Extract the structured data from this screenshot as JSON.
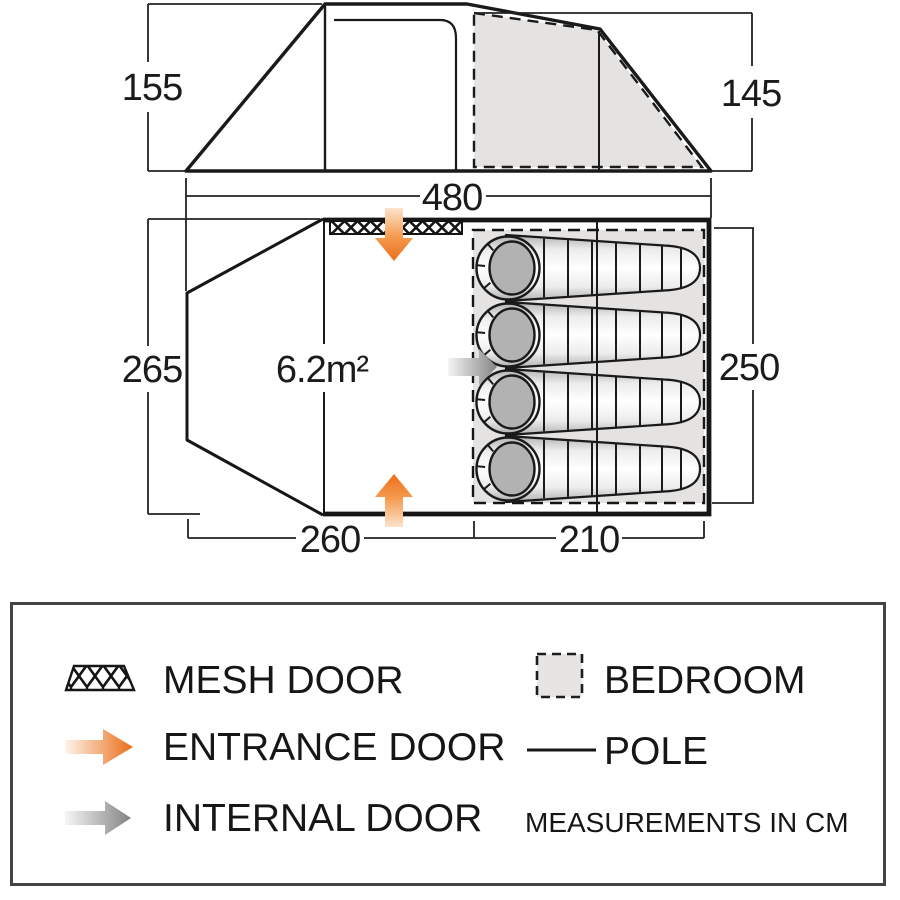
{
  "diagram": {
    "side_view": {
      "left_height_cm": "155",
      "right_height_cm": "145",
      "length_cm": "480"
    },
    "floor_plan": {
      "front_depth_cm": "265",
      "bedroom_depth_cm": "250",
      "living_length_cm": "260",
      "bedroom_length_cm": "210",
      "living_area_label": "6.2m²",
      "sleeping_bag_count": 4
    }
  },
  "legend": {
    "mesh_door": "MESH DOOR",
    "entrance_door": "ENTRANCE DOOR",
    "internal_door": "INTERNAL DOOR",
    "bedroom": "BEDROOM",
    "pole": "POLE",
    "note": "MEASUREMENTS IN CM"
  },
  "colors": {
    "accent_orange": "#eb6e1a",
    "arrow_gray": "#8a8a8a",
    "bedroom_fill": "#e4e3e1",
    "line": "#1a1a1a"
  }
}
